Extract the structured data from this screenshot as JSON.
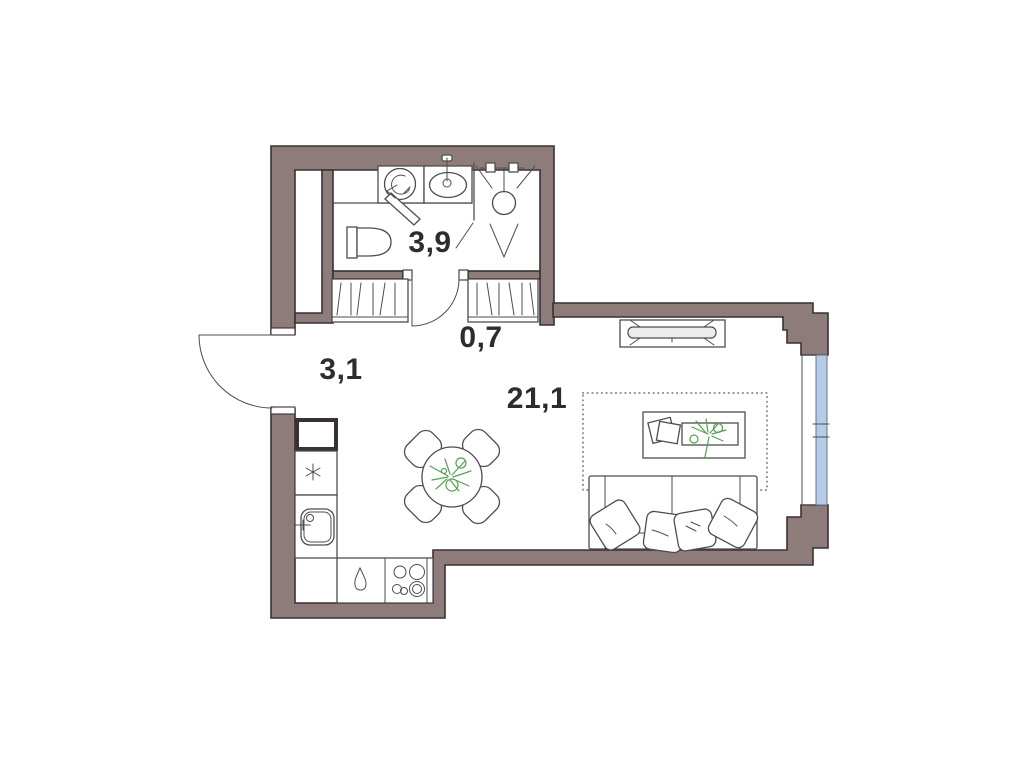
{
  "plan": {
    "type": "apartment-floor-plan",
    "rooms": [
      {
        "id": "bathroom",
        "area_label": "3,9"
      },
      {
        "id": "hallway-wardrobe",
        "area_label": "0,7"
      },
      {
        "id": "entry-hall",
        "area_label": "3,1"
      },
      {
        "id": "living-kitchen",
        "area_label": "21,1"
      }
    ],
    "colors": {
      "background": "#ffffff",
      "wall_fill": "#8d7c79",
      "wall_outline": "#3a3134",
      "furniture_line": "#4d4d4d",
      "plant_green": "#57a052",
      "window_glass": "#b5cbe7",
      "label_text": "#2d2d2d"
    },
    "icons": [
      "washing-machine-icon",
      "washbasin-icon",
      "shower-icon",
      "toilet-icon",
      "mirror-icon",
      "wardrobe-icon",
      "entry-door-icon",
      "interior-door-icon",
      "vent-shaft-icon",
      "refrigerator-icon",
      "kitchen-sink-icon",
      "kettle-drop-icon",
      "stove-icon",
      "dining-table-icon",
      "chair-icon",
      "plant-icon",
      "tv-icon",
      "rug-icon",
      "coffee-table-icon",
      "sofa-icon",
      "pillow-icon",
      "window-icon"
    ]
  }
}
